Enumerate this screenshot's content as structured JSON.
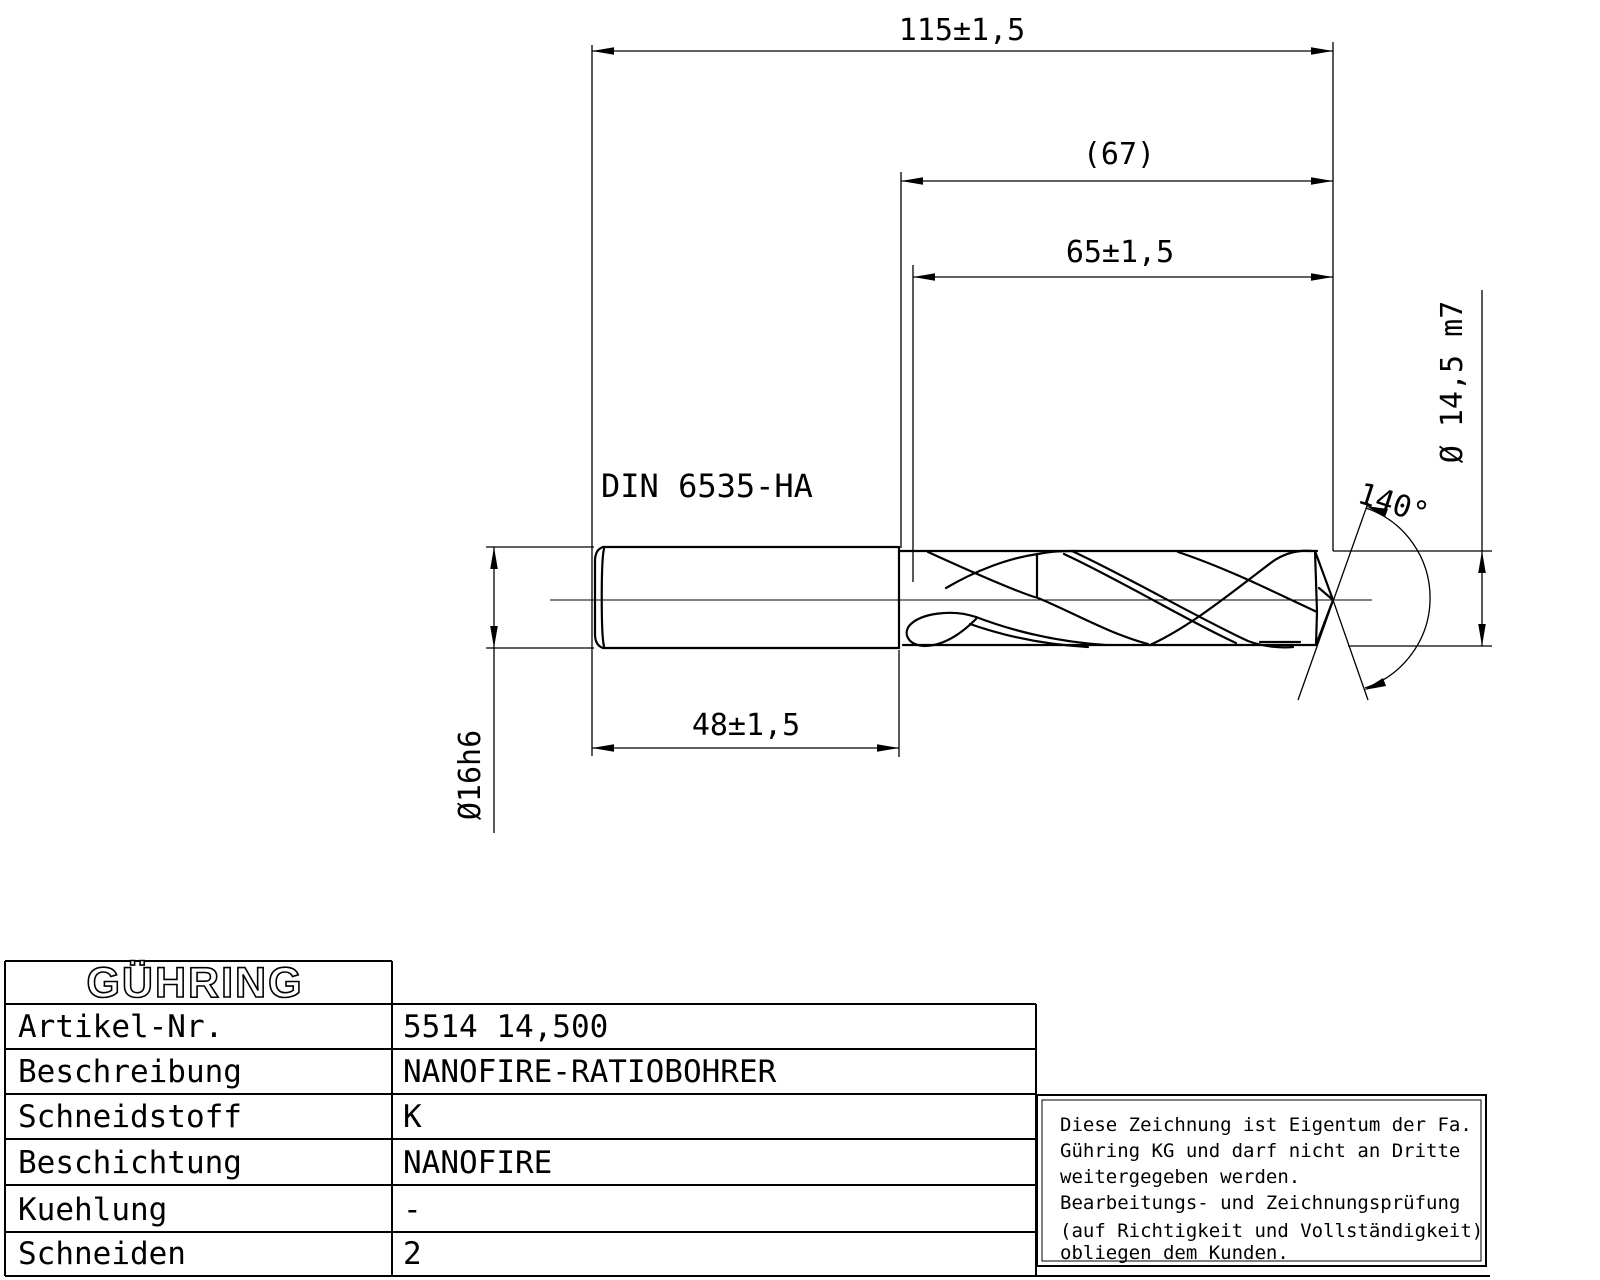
{
  "drawing": {
    "standard_label": "DIN 6535-HA",
    "dimensions": {
      "overall_length": "115±1,5",
      "flute_length_ref": "(67)",
      "flute_length": "65±1,5",
      "cutting_diameter": "Ø 14,5 m7",
      "point_angle": "140°",
      "shank_diameter": "Ø16h6",
      "shank_length": "48±1,5"
    }
  },
  "title_block": {
    "logo": "GÜHRING",
    "rows": [
      {
        "label": "Artikel-Nr.",
        "value": "5514 14,500"
      },
      {
        "label": "Beschreibung",
        "value": "NANOFIRE-RATIOBOHRER"
      },
      {
        "label": "Schneidstoff",
        "value": "K"
      },
      {
        "label": "Beschichtung",
        "value": "NANOFIRE"
      },
      {
        "label": "Kuehlung",
        "value": "-"
      },
      {
        "label": "Schneiden",
        "value": "2"
      }
    ]
  },
  "notice": {
    "lines": [
      "Diese Zeichnung ist Eigentum der Fa.",
      "Gühring KG und darf nicht an Dritte",
      "weitergegeben werden.",
      "Bearbeitungs- und Zeichnungsprüfung",
      "(auf Richtigkeit und Vollständigkeit)",
      "obliegen dem Kunden."
    ]
  },
  "colors": {
    "ink": "#000000",
    "paper": "#ffffff"
  }
}
